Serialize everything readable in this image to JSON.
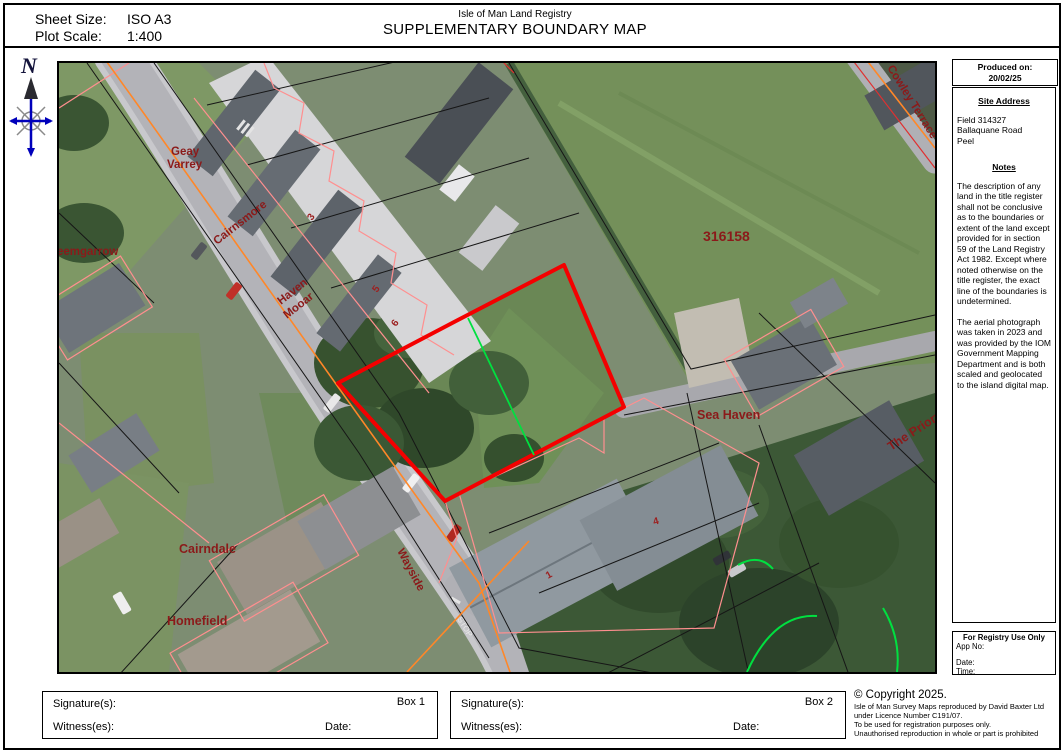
{
  "header": {
    "sheet_size_label": "Sheet Size:",
    "sheet_size_value": "ISO A3",
    "plot_scale_label": "Plot Scale:",
    "plot_scale_value": "1:400",
    "registry_name": "Isle of Man Land Registry",
    "title": "SUPPLEMENTARY BOUNDARY MAP"
  },
  "compass": {
    "north_label": "N"
  },
  "map": {
    "parcel_number": "316158",
    "labels": {
      "geay_line1": "Geay",
      "geay_line2": "Varrey",
      "cairnsmore": "Cairnsmore",
      "leemgarrow": "eemgarrow",
      "haven_line1": "Haven",
      "haven_line2": "Mooar",
      "cowley_terrace": "Cowley Terrace",
      "sea_haven": "Sea Haven",
      "the_priory": "The Priory",
      "cairndale": "Cairndale",
      "wayside": "Wayside",
      "homefield": "Homefield",
      "stop_marking": "STOP",
      "house_numbers": [
        "3",
        "5",
        "6",
        "1",
        "4"
      ]
    },
    "colors": {
      "boundary_red": "#f40000",
      "survey_green": "#00e040",
      "parcel_pink": "#ff8f8f",
      "parcel_black": "#161616",
      "road_orange": "#ff8728",
      "label_dark_red": "#8b1a1a"
    }
  },
  "sidebar": {
    "produced_on_label": "Produced on:",
    "produced_on_date": "20/02/25",
    "site_address_heading": "Site Address",
    "site_address_lines": [
      "Field 314327",
      "Ballaquane Road",
      "Peel"
    ],
    "notes_heading": "Notes",
    "notes_paragraph1": "The description of any land in the title register shall not be conclusive as to the boundaries or extent of the land except provided for in section 59 of the Land Registry Act 1982. Except where noted otherwise on the title register, the exact line of the boundaries is undetermined.",
    "notes_paragraph2": "The aerial photograph was taken in 2023 and was provided by the IOM Government Mapping Department and is both scaled and geolocated to the island digital map.",
    "registry_box": {
      "heading": "For Registry Use Only",
      "app_no_label": "App No:",
      "date_label": "Date:",
      "time_label": "Time:"
    }
  },
  "footer": {
    "box1": {
      "signature_label": "Signature(s):",
      "box_label": "Box 1",
      "witness_label": "Witness(es):",
      "date_label": "Date:"
    },
    "box2": {
      "signature_label": "Signature(s):",
      "box_label": "Box 2",
      "witness_label": "Witness(es):",
      "date_label": "Date:"
    },
    "copyright_lines": [
      "© Copyright 2025.",
      "Isle of Man Survey Maps reproduced by David Baxter Ltd",
      "under Licence Number C191/07.",
      "To be used for registration purposes only.",
      "Unauthorised reproduction in whole or part is prohibited"
    ]
  }
}
